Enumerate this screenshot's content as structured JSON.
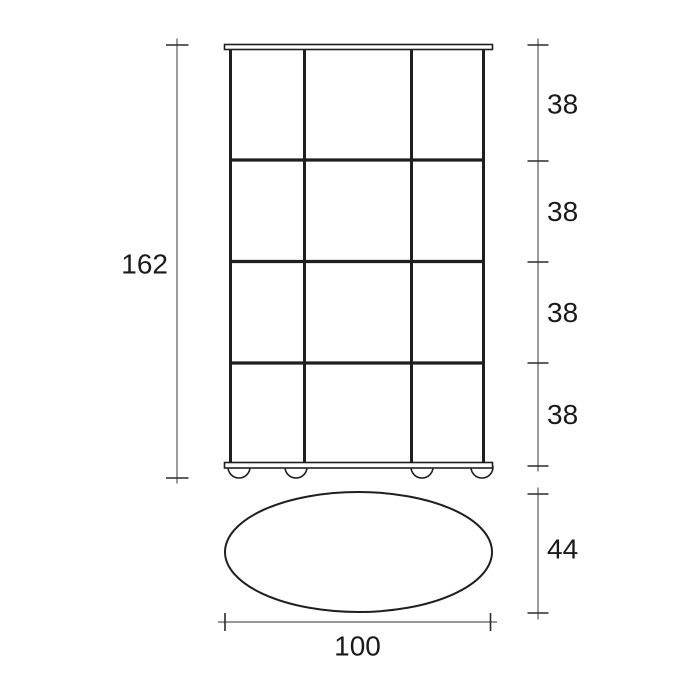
{
  "drawing": {
    "kind": "furniture-dimension-drawing",
    "front_view": {
      "grid_columns": 3,
      "grid_rows": 4,
      "feet_count": 4
    },
    "top_view": {
      "shape": "ellipse"
    },
    "dimensions": {
      "overall_height": "162",
      "compartment_heights": [
        "38",
        "38",
        "38",
        "38"
      ],
      "depth": "44",
      "width": "100"
    },
    "colors": {
      "object_line": "#1f1f1f",
      "dimension_line": "#5a5a5a",
      "tick": "#2b2b2b",
      "text": "#1a1a1a",
      "background": "#ffffff"
    }
  }
}
